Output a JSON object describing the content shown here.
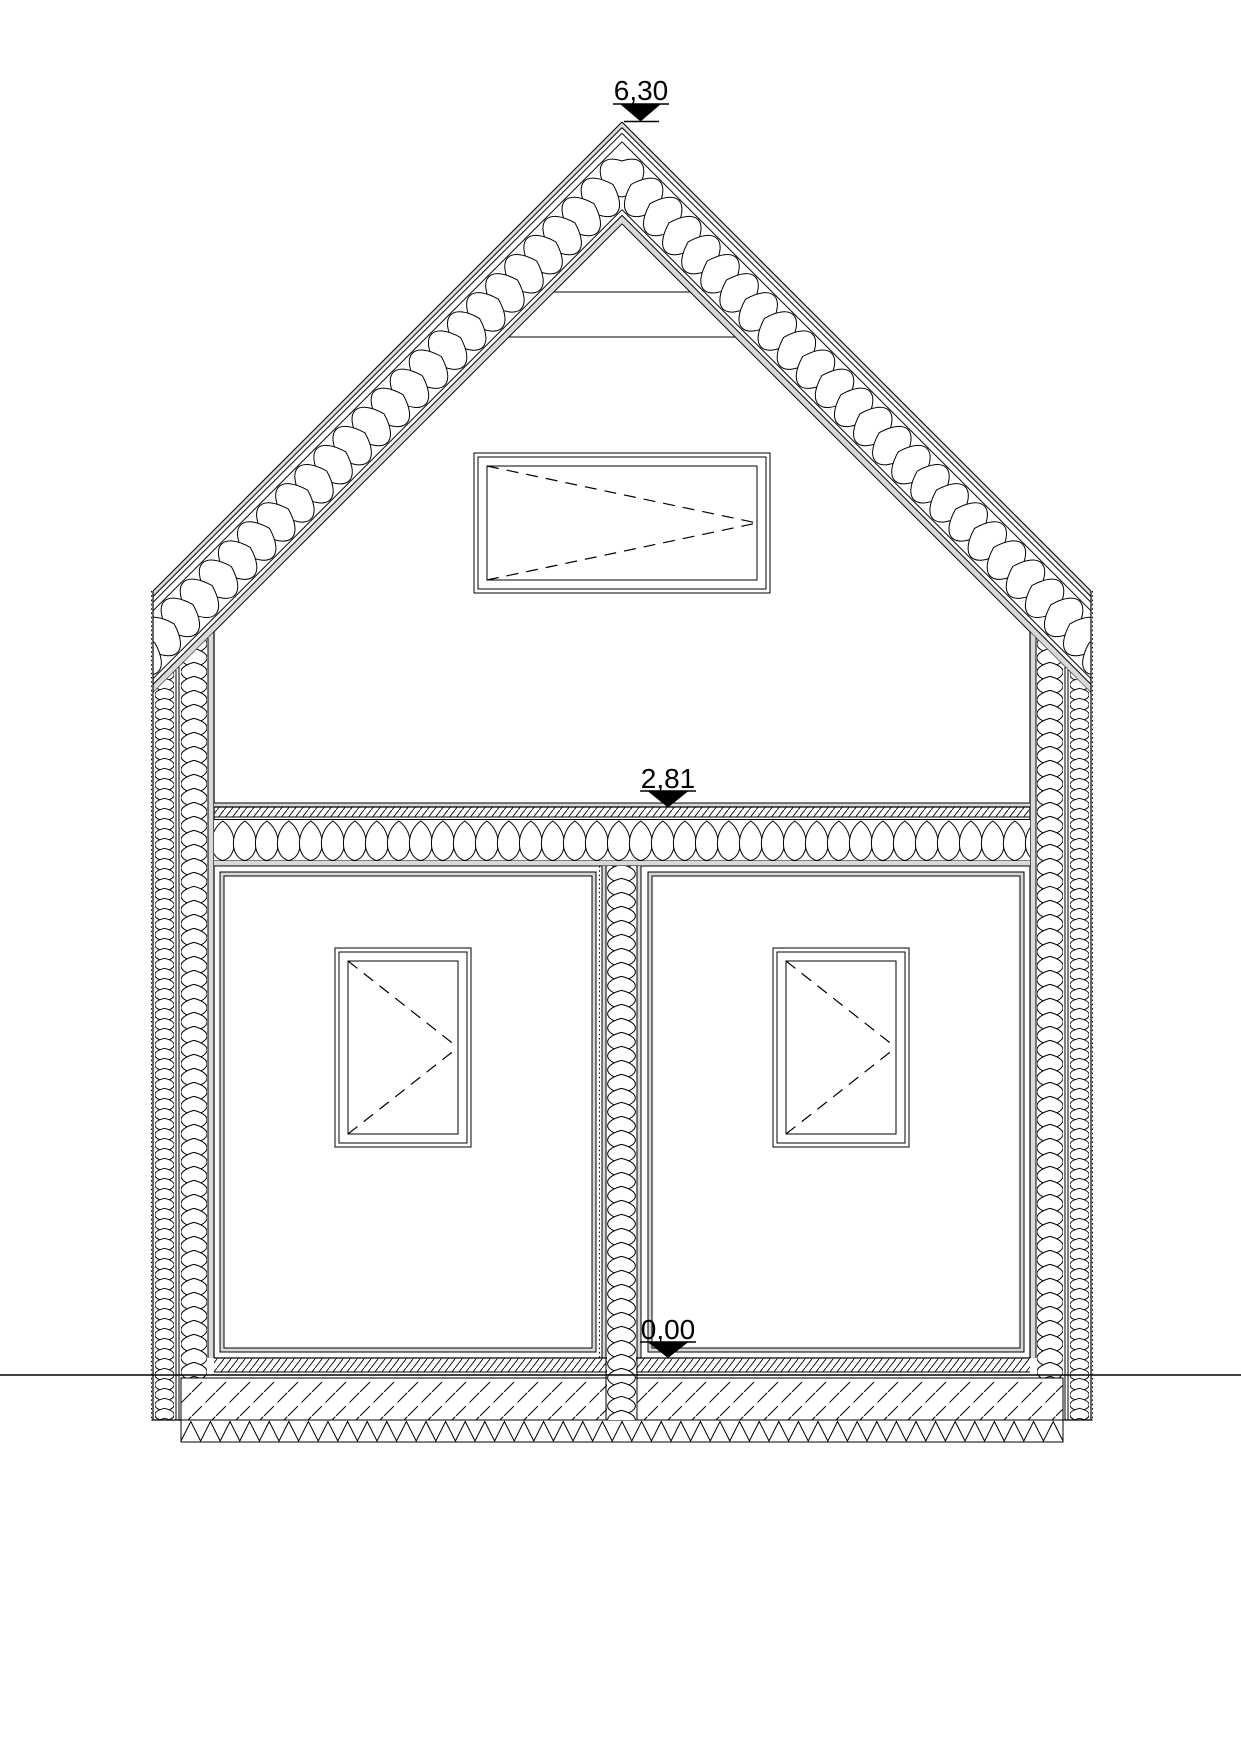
{
  "drawing": {
    "title": "house-cross-section",
    "markers": {
      "ridge": {
        "label": "6,30"
      },
      "upper_floor": {
        "label": "2,81"
      },
      "ground": {
        "label": "0,00"
      }
    },
    "colors": {
      "ink": "#000000",
      "lining_gray": "#d9d9d9",
      "paper": "#ffffff"
    }
  }
}
